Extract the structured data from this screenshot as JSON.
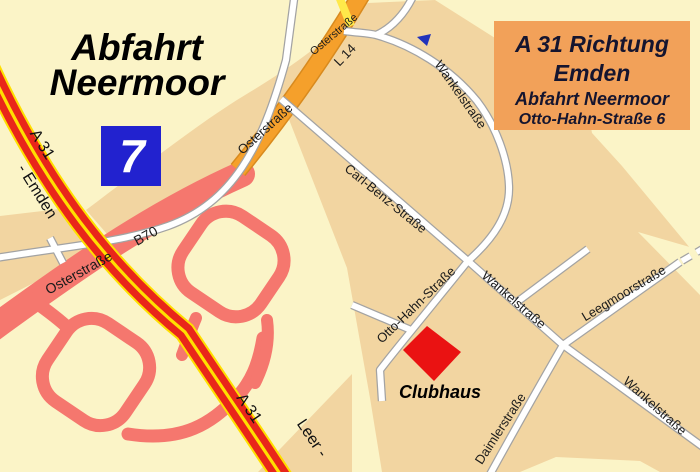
{
  "title": {
    "line1": "Abfahrt",
    "line2": "Neermoor"
  },
  "exit_sign": {
    "number": "7"
  },
  "info_box": {
    "line1": "A 31 Richtung",
    "line2": "Emden",
    "line3": "Abfahrt Neermoor",
    "line4": "Otto-Hahn-Straße 6"
  },
  "highway": {
    "name_upper": "A 31",
    "name_lower": "A 31",
    "direction_north": "- Emden",
    "direction_south": "Leer -"
  },
  "roads": {
    "osterstrasse_top": "Osterstraße",
    "l14": "L 14",
    "osterstrasse_mid": "Osterstraße",
    "osterstrasse_b70": "Osterstraße",
    "b70": "B70",
    "wankelstrasse_north": "Wankelstraße",
    "wankelstrasse_mid": "Wankelstraße",
    "wankelstrasse_southeast": "Wankelstraße",
    "carl_benz_strasse": "Carl-Benz-Straße",
    "otto_hahn_strasse": "Otto-Hahn-Straße",
    "leegmoorstrasse": "Leegmoorstraße",
    "daimlerstrasse": "Daimlerstraße"
  },
  "poi": {
    "clubhaus": "Clubhaus"
  },
  "colors": {
    "background_cream": "#FBF4C7",
    "built_area_tan": "#F2D5A1",
    "ramp_salmon": "#F5776E",
    "motorway_red": "#E9261A",
    "motorway_yellow": "#FFDF00",
    "main_road_orange": "#F5A02B",
    "minor_road_yellow": "#FFE94A",
    "road_casing_gray": "#A3A3A3",
    "exit_sign_blue": "#2222CF",
    "info_box_orange": "#F2A159",
    "info_box_text": "#15152F",
    "clubhaus_red": "#EA1212"
  }
}
